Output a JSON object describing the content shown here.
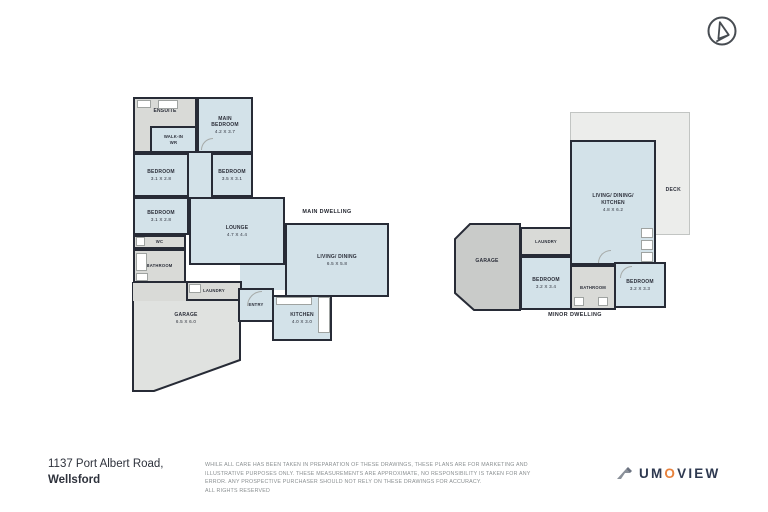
{
  "compass": {
    "icon": "north-arrow-compass"
  },
  "main": {
    "title": "MAIN DWELLING",
    "rooms": {
      "ensuite": {
        "name": "ENSUITE"
      },
      "walk_in": {
        "name": "WALK-IN WR"
      },
      "main_bedroom": {
        "name": "MAIN BEDROOM",
        "dims": "4.2 X 3.7"
      },
      "bedroom_1": {
        "name": "BEDROOM",
        "dims": "3.1 X 2.8"
      },
      "bedroom_2": {
        "name": "BEDROOM",
        "dims": "3.5 X 3.1"
      },
      "bedroom_3": {
        "name": "BEDROOM",
        "dims": "3.1 X 2.8"
      },
      "wc": {
        "name": "WC"
      },
      "bathroom": {
        "name": "BATHROOM"
      },
      "lounge": {
        "name": "LOUNGE",
        "dims": "4.7 X 4.4"
      },
      "living_dining": {
        "name": "LIVING/ DINING",
        "dims": "6.5 X 5.8"
      },
      "laundry": {
        "name": "LAUNDRY"
      },
      "entry": {
        "name": "ENTRY"
      },
      "kitchen": {
        "name": "KITCHEN",
        "dims": "4.0 X 3.0"
      },
      "garage": {
        "name": "GARAGE",
        "dims": "6.5 X 6.0"
      }
    }
  },
  "minor": {
    "title": "MINOR DWELLING",
    "rooms": {
      "living_dining_kitchen": {
        "name": "LIVING/ DINING/ KITCHEN",
        "dims": "4.8 X 6.2"
      },
      "deck": {
        "name": "DECK"
      },
      "garage": {
        "name": "GARAGE"
      },
      "laundry": {
        "name": "LAUNDRY"
      },
      "bedroom_1": {
        "name": "BEDROOM",
        "dims": "3.2 X 3.4"
      },
      "bathroom": {
        "name": "BATHROOM"
      },
      "bedroom_2": {
        "name": "BEDROOM",
        "dims": "3.2 X 3.3"
      }
    }
  },
  "footer": {
    "address_line1": "1137 Port Albert Road,",
    "address_line2": "Wellsford",
    "disclaimer": "WHILE ALL CARE HAS BEEN TAKEN IN PREPARATION OF THESE DRAWINGS, THESE PLANS ARE FOR MARKETING AND\nILLUSTRATIVE PURPOSES ONLY. THESE MEASUREMENTS ARE APPROXIMATE, NO RESPONSIBILITY IS TAKEN FOR ANY\nERROR. ANY PROSPECTIVE PURCHASER SHOULD NOT RELY ON THESE DRAWINGS FOR ACCURACY.\nALL RIGHTS RESERVED"
  },
  "logo": {
    "part1": "UM",
    "part2": "O",
    "part3": "VIEW"
  },
  "colors": {
    "wall": "#272b36",
    "room_blue": "#d3e2e9",
    "room_gray": "#d9dad7",
    "deck_gray": "#ecedeb",
    "garage_gray": "#c9cbc9",
    "accent_orange": "#e8823c",
    "text_dark": "#2e3950"
  }
}
